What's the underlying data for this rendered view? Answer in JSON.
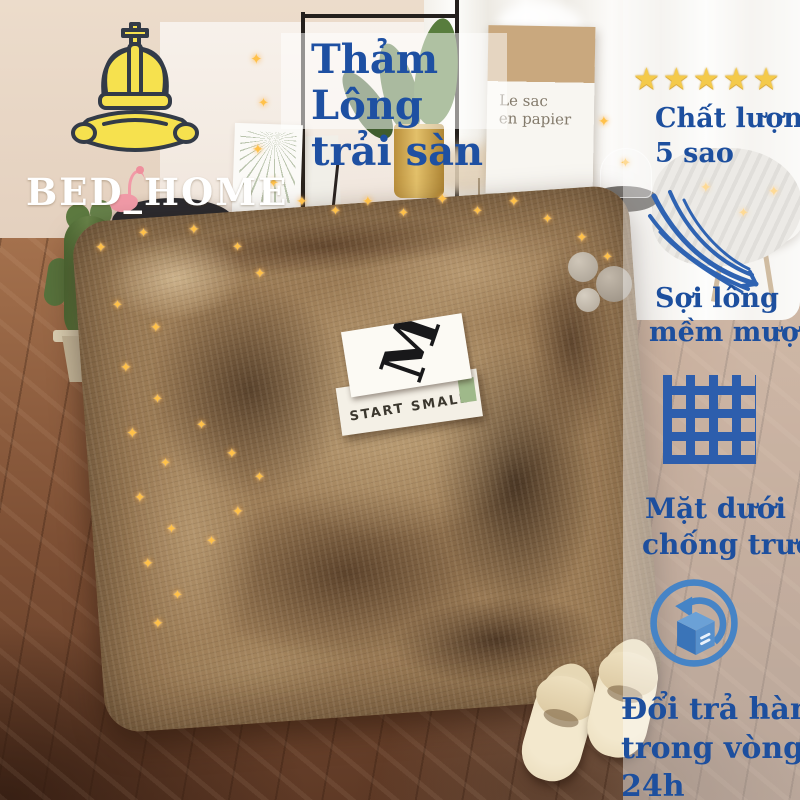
{
  "logo": {
    "brand": "BED_HOME"
  },
  "title_badge": {
    "line1": "Thảm Lông",
    "line2": "trải sàn"
  },
  "rating": {
    "star_count": 5,
    "line1": "Chất lượng",
    "line2": "5 sao"
  },
  "features": [
    {
      "icon": "feather-icon",
      "line1": "Sợi lông",
      "line2": "mềm mượt"
    },
    {
      "icon": "anti-slip-grid-icon",
      "line1": "Mặt dưới",
      "line2": "chống trượt"
    },
    {
      "icon": "return-package-icon",
      "line1": "Đổi trả hàng",
      "line2": "trong vòng",
      "line3": "24h"
    }
  ],
  "scene": {
    "book_cover_letter": "M",
    "book_spine_title": "START SMALL",
    "paper_bag_line1": "Le sac",
    "paper_bag_line2": "en papier",
    "poster_caption": "NATURE",
    "basket_sign": "PARKE"
  },
  "colors": {
    "text_blue": "#1d4f9e",
    "icon_blue": "#4384c6",
    "star_gold": "#f4ca4a",
    "logo_yellow": "#f6e14e",
    "logo_text": "#ffffff"
  }
}
